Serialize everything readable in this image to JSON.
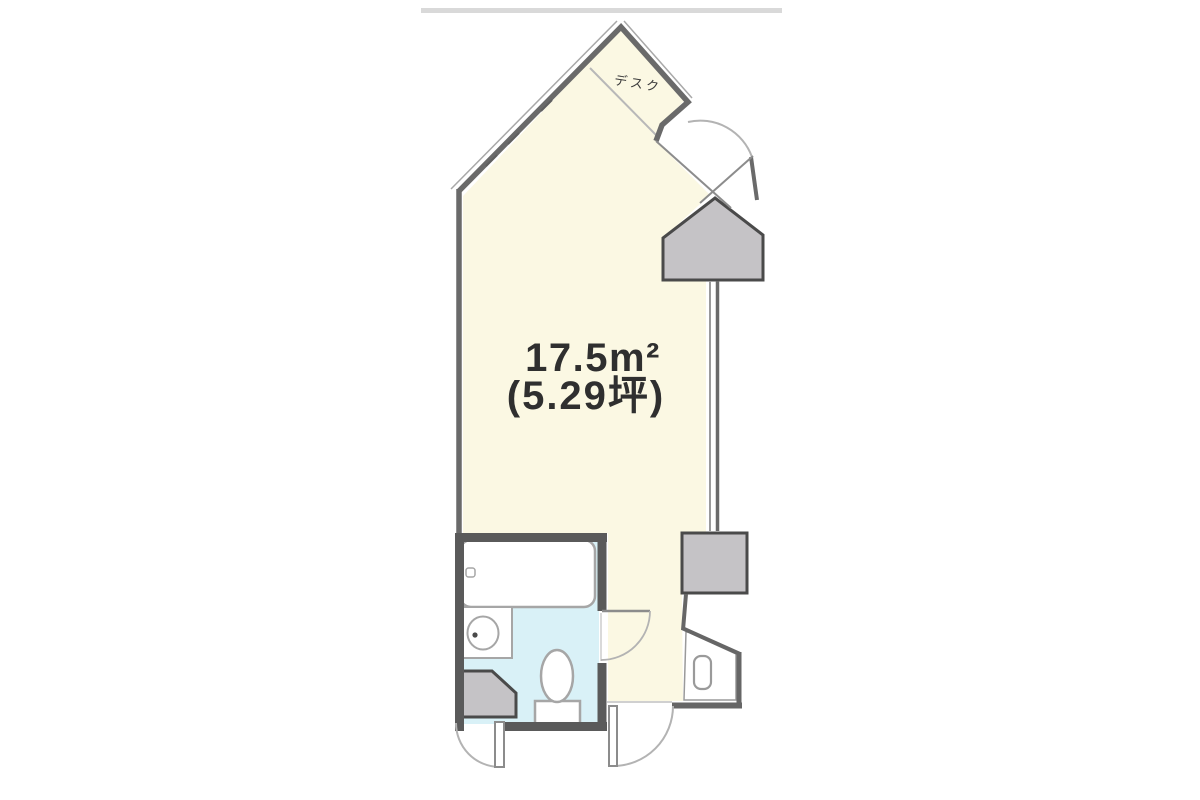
{
  "floor_plan": {
    "area_label": "17.5m²",
    "area_tsubo_label": "(5.29坪)",
    "desk_label": "デスク"
  },
  "colors": {
    "room_fill": "#FBF8E3",
    "bathroom_floor": "#D9F1F7",
    "pillar_fill": "#C5C3C6",
    "wall_main": "#6A6A6A",
    "wall_bathroom": "#5A5A5A",
    "fixture_stroke": "#A6A6A6",
    "door_arc": "#B3B3B3",
    "door_leaf": "#8C8C8C",
    "scan_edge": "#D9D9D9"
  }
}
